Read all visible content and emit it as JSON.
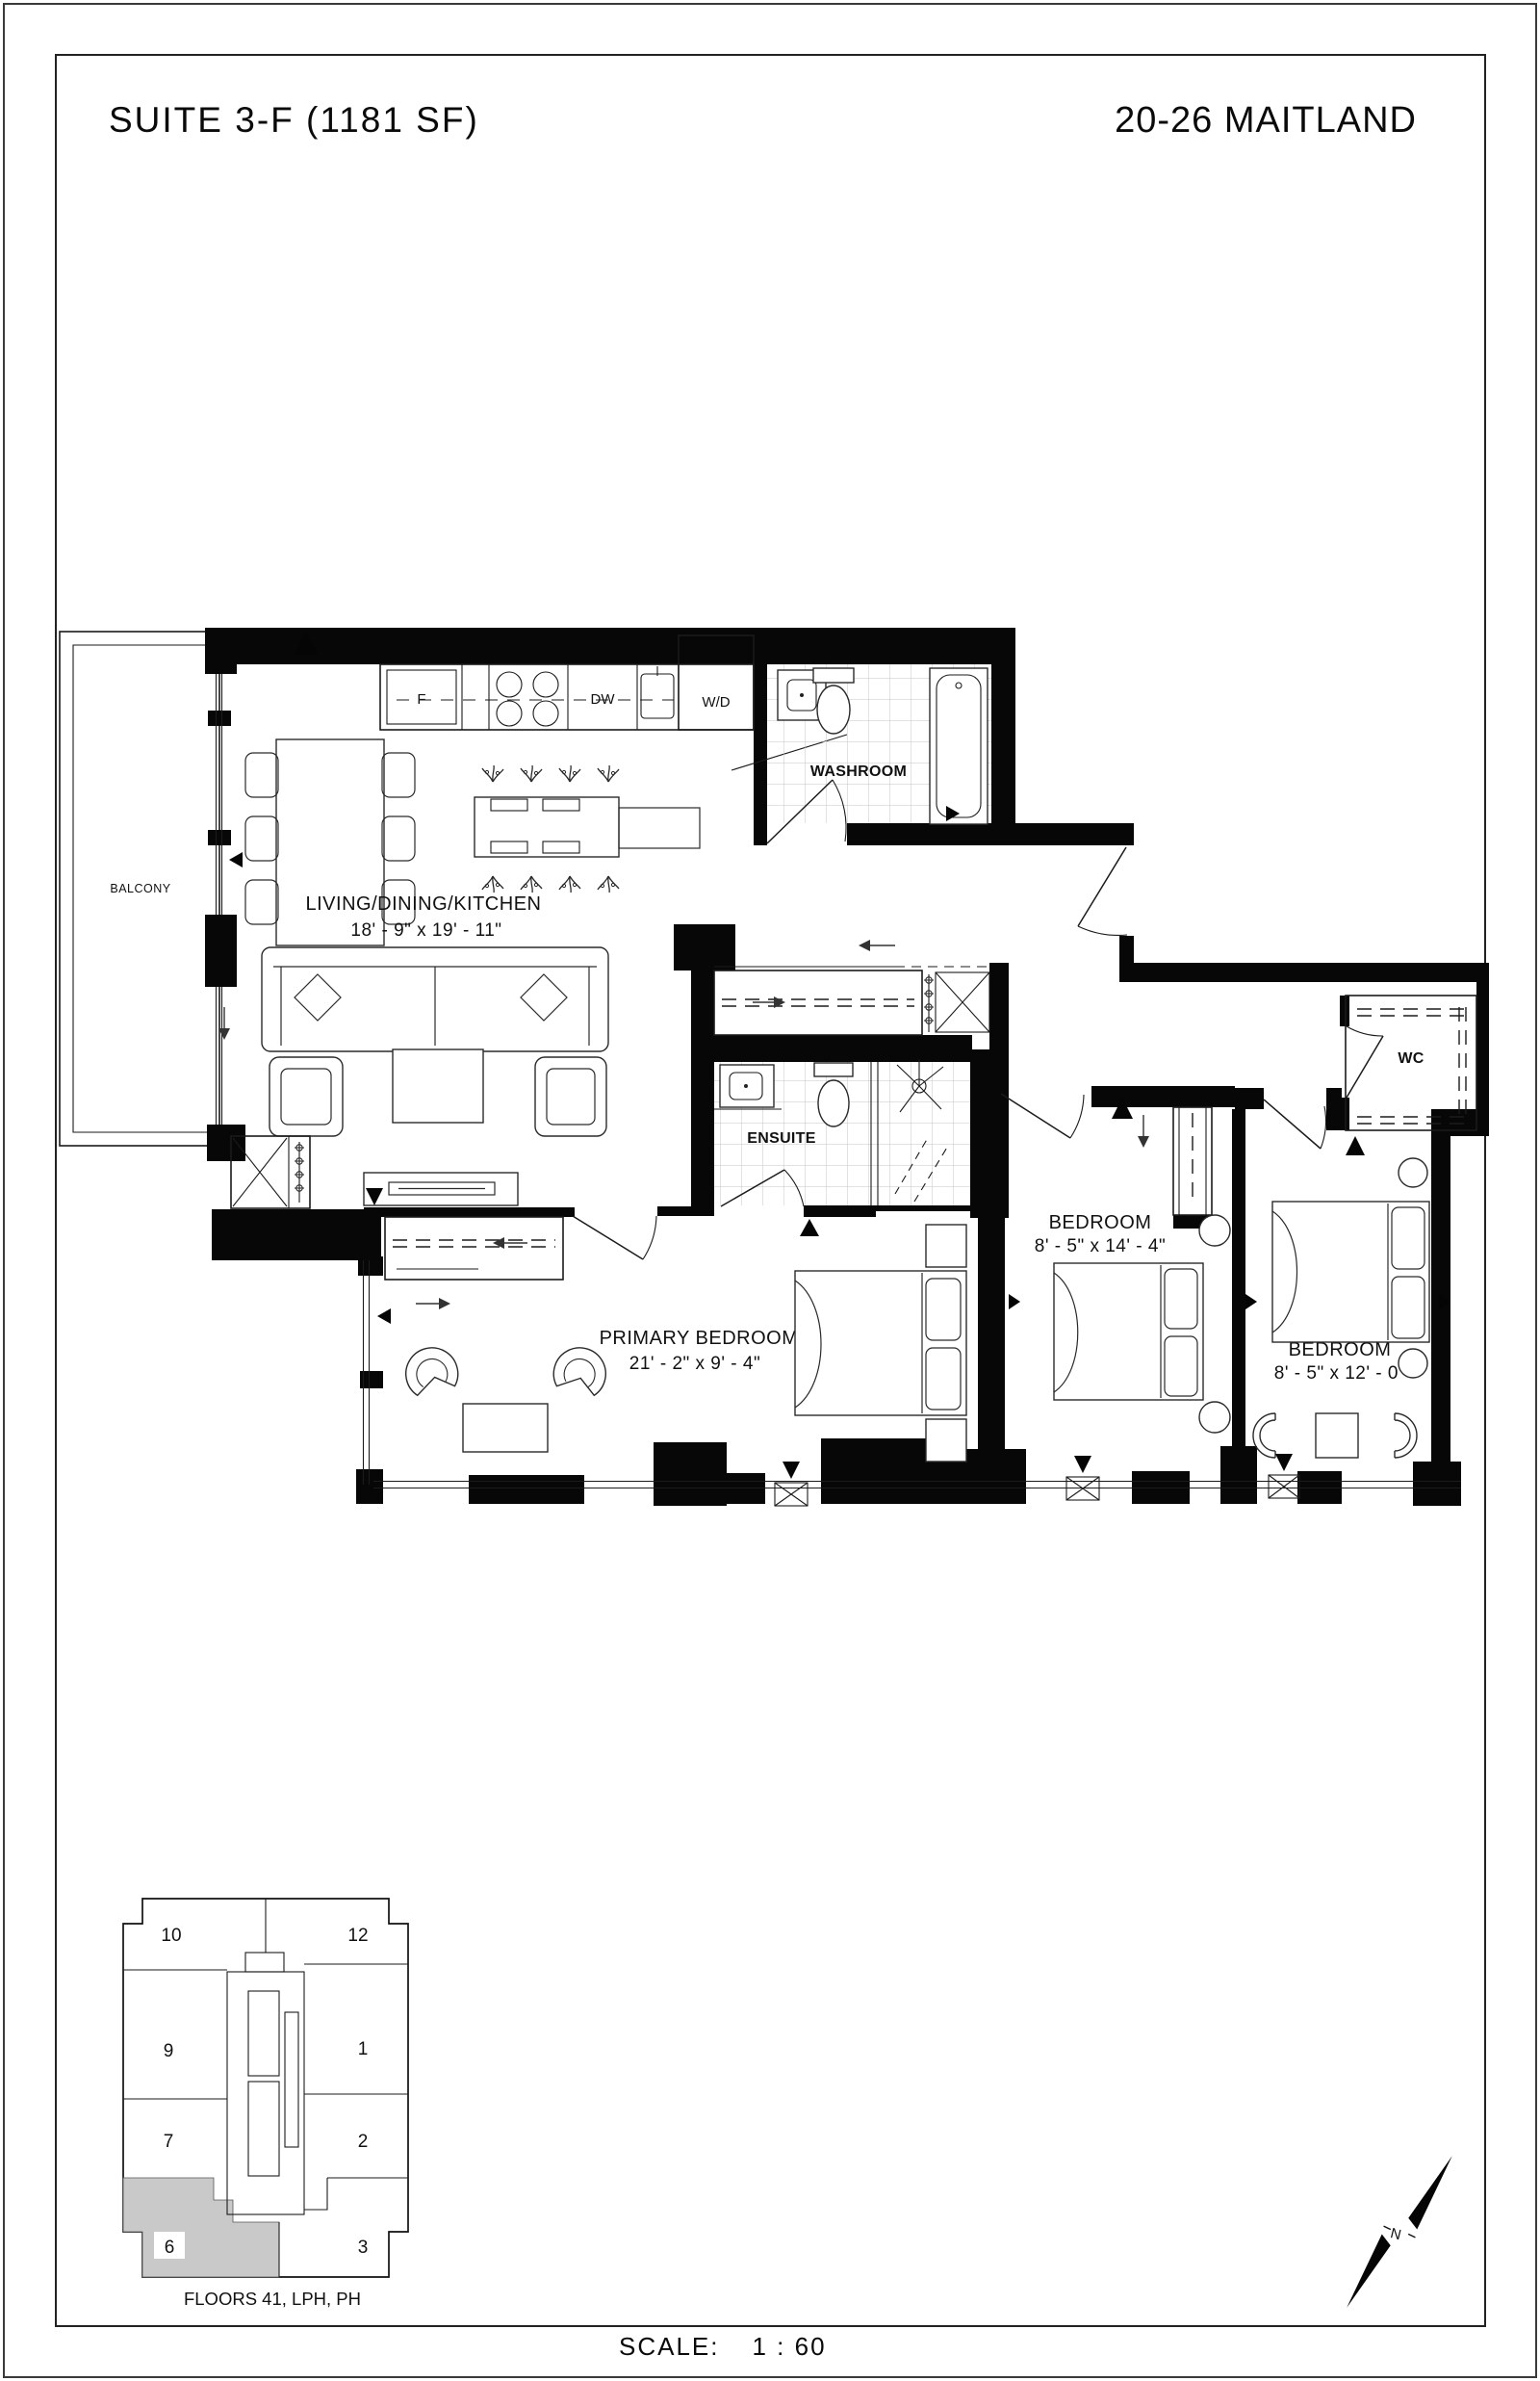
{
  "header": {
    "suite_title": "SUITE 3-F (1181 SF)",
    "building_title": "20-26 MAITLAND"
  },
  "rooms": {
    "balcony": {
      "name": "BALCONY"
    },
    "living": {
      "name": "LIVING/DINING/KITCHEN",
      "dims": "18' - 9\" x  19' - 11\""
    },
    "washroom": {
      "name": "WASHROOM"
    },
    "ensuite": {
      "name": "ENSUITE"
    },
    "wc": {
      "name": "WC"
    },
    "primary_bedroom": {
      "name": "PRIMARY BEDROOM",
      "dims": "21' - 2\" x  9' - 4\""
    },
    "bedroom_2": {
      "name": "BEDROOM",
      "dims": "8' - 5\" x  14' - 4\""
    },
    "bedroom_3": {
      "name": "BEDROOM",
      "dims": "8' - 5\" x  12' - 0\""
    }
  },
  "appliances": {
    "fridge": "F",
    "dishwasher": "DW",
    "washer_dryer": "W/D"
  },
  "keyplan": {
    "caption": "FLOORS 41, LPH, PH",
    "highlighted_unit": "6",
    "highlight_color": "#c9c9c9",
    "units": {
      "u10": "10",
      "u12": "12",
      "u9": "9",
      "u1": "1",
      "u7": "7",
      "u2": "2",
      "u6": "6",
      "u3": "3"
    }
  },
  "compass": {
    "label": "N"
  },
  "scale_bar": {
    "label": "SCALE:",
    "value": "1 : 60"
  }
}
